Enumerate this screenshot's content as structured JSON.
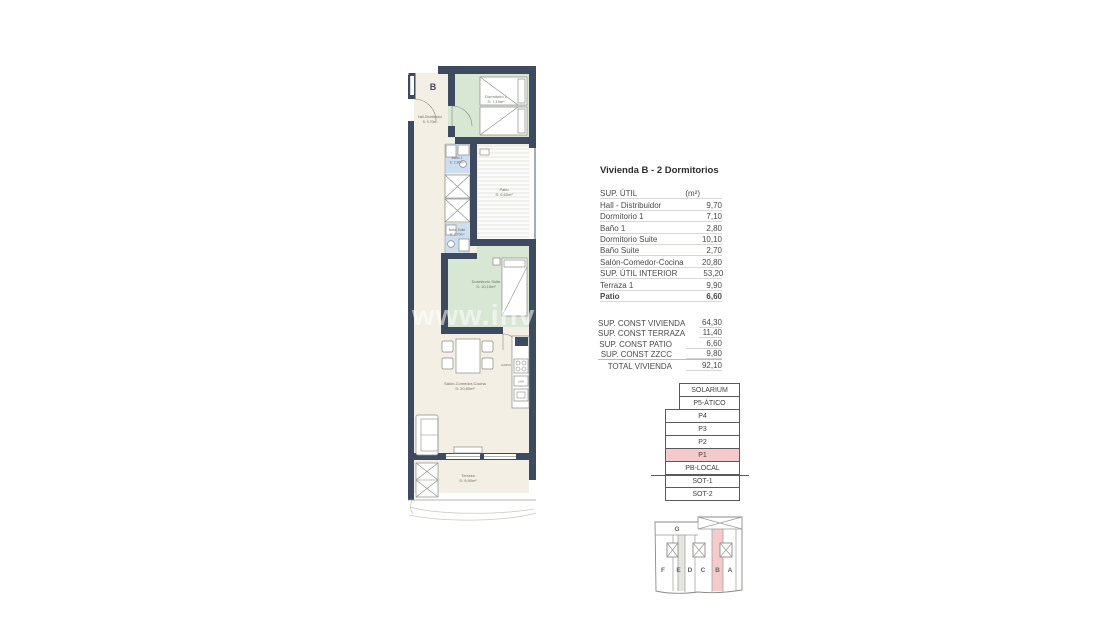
{
  "watermark": "www.inves",
  "unit_info": {
    "title": "Vivienda B - 2 Dormitorios",
    "sup_util": {
      "header_label": "SUP. ÚTIL",
      "header_unit": "(m²)",
      "rows": [
        {
          "label": "Hall - Distribuidor",
          "value": "9,70"
        },
        {
          "label": "Dormitorio 1",
          "value": "7,10"
        },
        {
          "label": "Baño 1",
          "value": "2,80"
        },
        {
          "label": "Dormitorio Suite",
          "value": "10,10"
        },
        {
          "label": "Baño Suite",
          "value": "2,70"
        },
        {
          "label": "Salón-Comedor-Cocina",
          "value": "20,80"
        },
        {
          "label": "SUP. ÚTIL INTERIOR",
          "value": "53,20"
        },
        {
          "label": "Terraza 1",
          "value": "9,90"
        },
        {
          "label": "Patio",
          "value": "6,60"
        }
      ]
    },
    "sup_const": {
      "rows": [
        {
          "label": "SUP. CONST VIVIENDA",
          "value": "64,30"
        },
        {
          "label": "SUP. CONST TERRAZA",
          "value": "11,40"
        },
        {
          "label": "SUP. CONST PATIO",
          "value": "6,60"
        },
        {
          "label": "SUP. CONST ZZCC",
          "value": "9,80"
        },
        {
          "label": "TOTAL VIVIENDA",
          "value": "92,10"
        }
      ]
    }
  },
  "levels": {
    "items": [
      "SOLARIUM",
      "P5-ÁTICO",
      "P4",
      "P3",
      "P2",
      "P1",
      "PB-LOCAL",
      "SOT-1",
      "SOT-2"
    ],
    "highlighted": "P1"
  },
  "key_plan": {
    "upper_unit": "G",
    "units": [
      "F",
      "E",
      "D",
      "C",
      "B",
      "A"
    ],
    "highlighted": "B"
  },
  "plan": {
    "entry_label": "B",
    "rooms": [
      {
        "label": "Hall-Distribuidor",
        "area": "S: 9,70m²"
      },
      {
        "label": "Dormitorio 1",
        "area": "S: 7,10m²"
      },
      {
        "label": "Baño 1",
        "area": "S: 2,80m²"
      },
      {
        "label": "Patio",
        "area": "S: 6,60m²"
      },
      {
        "label": "Baño Suite",
        "area": "S: 2,70m²"
      },
      {
        "label": "Dormitorio Suite",
        "area": "S: 10,10m²"
      },
      {
        "label": "Salón-Comedor-Cocina",
        "area": "S: 20,80m²"
      },
      {
        "label": "Terraza",
        "area": "S: 9,90m²"
      }
    ],
    "kitchen": [
      "HORNO",
      "LAVA"
    ]
  },
  "colors": {
    "wall": "#3e4a60",
    "green": "#d7e7d3",
    "blue": "#ccdef0",
    "cream": "#f4efe4",
    "pink": "#f5caca"
  }
}
